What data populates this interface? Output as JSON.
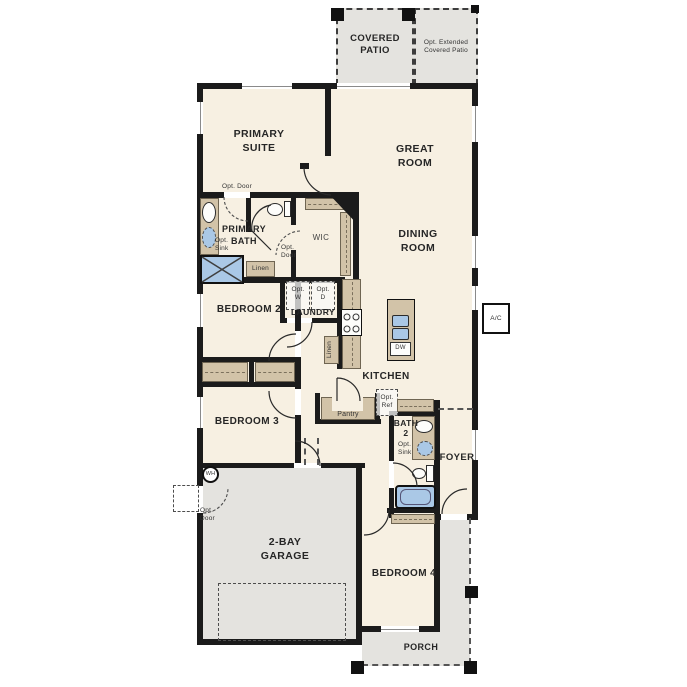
{
  "title": "Single-story floor plan",
  "rooms": {
    "covered_patio": "COVERED\nPATIO",
    "opt_extended_patio": "Opt. Extended\nCovered Patio",
    "primary_suite": "PRIMARY\nSUITE",
    "great_room": "GREAT\nROOM",
    "dining_room": "DINING\nROOM",
    "primary_bath": "PRIMARY\nBATH",
    "wic": "WIC",
    "laundry": "LAUNDRY",
    "bedroom2": "BEDROOM 2",
    "bedroom3": "BEDROOM 3",
    "kitchen": "KITCHEN",
    "pantry": "Pantry",
    "bath2": "BATH\n2",
    "foyer": "FOYER",
    "garage": "2-BAY\nGARAGE",
    "bedroom4": "BEDROOM 4",
    "porch": "PORCH"
  },
  "annotations": {
    "opt_door_suite": "Opt. Door",
    "opt_door_wic": "Opt.\nDoor",
    "opt_door_garage": "Opt.\nDoor",
    "opt_sink_primary": "Opt.\nSink",
    "opt_sink_bath2": "Opt.\nSink",
    "linen_bath": "Linen",
    "linen_hall": "Linen",
    "opt_washer": "Opt.\nW",
    "opt_dryer": "Opt.\nD",
    "opt_ref": "Opt.\nRef",
    "dishwasher": "DW",
    "water_heater": "WH",
    "ac_unit": "A/C"
  },
  "colors": {
    "wall": "#1b1b1b",
    "cream": "#f7f0e2",
    "gray": "#e4e3df",
    "tan": "#d2c3a8",
    "blue": "#aac8e6"
  }
}
